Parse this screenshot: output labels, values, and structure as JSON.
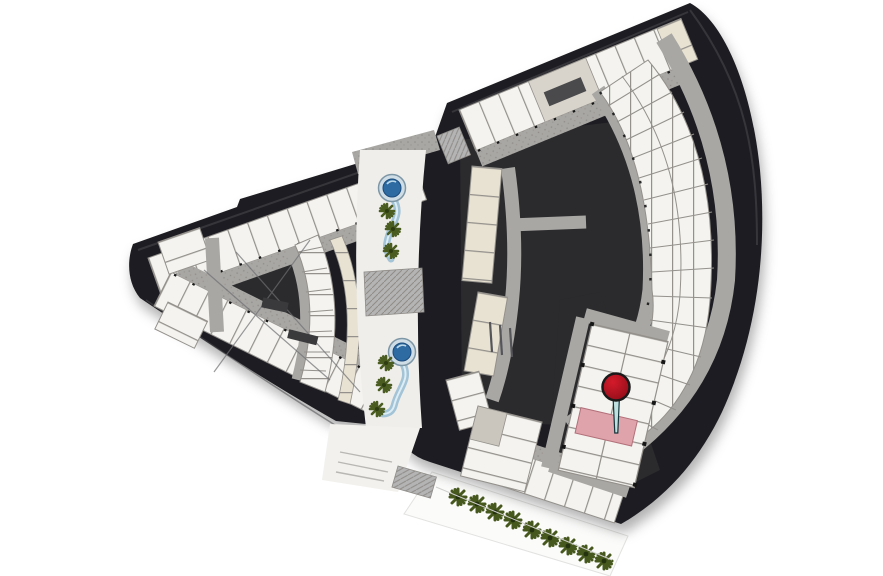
{
  "scene": {
    "type": "site-floor-plan",
    "description": "Aerial master floor plan of a two-wing curved building complex with a central landscaped walkway, rendered on a white background",
    "selected_unit": {
      "highlighted": true,
      "location": "lower-right unit cluster of the right wing",
      "highlight_color_ref": "highlight_unit"
    },
    "marker": {
      "kind": "map-pin",
      "style": "red ball pin with light stem",
      "points_to": "selected (pink) unit"
    }
  },
  "landscape": {
    "pools": 2,
    "walkway_palm_trees": 6,
    "perimeter_trees": 9
  },
  "wings": {
    "left": {
      "shape": "tapered wedge with dark core and X roof lines",
      "unit_rows": 3
    },
    "right": {
      "shape": "curved fan with radial unit arc around dark courtyard",
      "unit_rows": 5
    }
  },
  "colors": {
    "background": "#ffffff",
    "building_dark": "#1e1e20",
    "building_mid": "#2b2b2d",
    "edge_highlight": "#4a4a4e",
    "corridor": "#a9a7a4",
    "corridor_speckle": "#8f8c88",
    "unit_fill": "#f4f3ef",
    "unit_line": "#94918c",
    "unit_cream": "#e8e2d2",
    "walkway": "#efeeea",
    "plaza": "#f2f1ed",
    "path_white": "#fbfbfa",
    "hatch": "#b4b4b4",
    "pool_rim": "#cfdde6",
    "pool_water": "#2e6ba2",
    "pool_stream": "#a3c3d6",
    "pool_stream_light": "#dcedf5",
    "palm_green": "#4a5c20",
    "tree_green": "#46581d",
    "door_dark": "#161616",
    "highlight_unit": "#dfa3ac",
    "pin_red": "#d41b2a",
    "pin_red_dark": "#8e0d19",
    "pin_outline": "#1a1a1a",
    "pin_stem": "#bfe0df"
  }
}
